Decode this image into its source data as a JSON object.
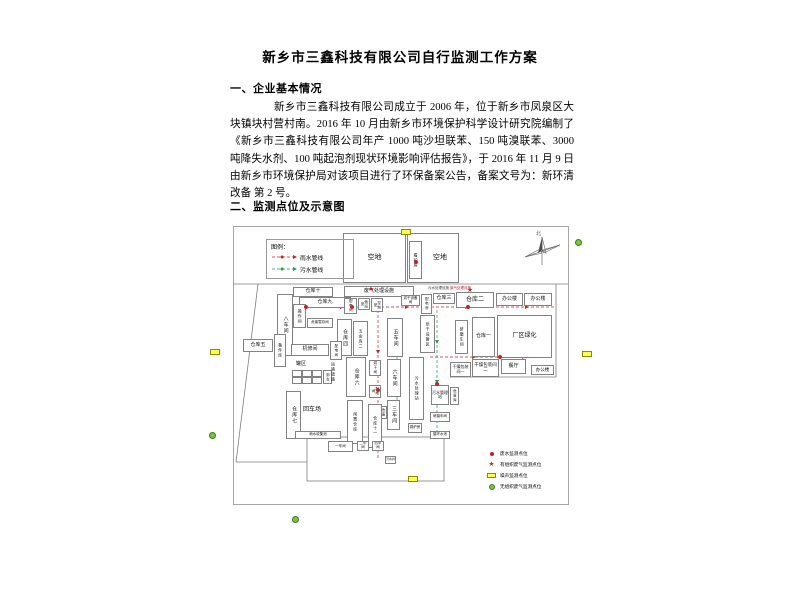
{
  "document": {
    "title": "新乡市三鑫科技有限公司自行监测工作方案",
    "sections": [
      {
        "heading": "一、企业基本情况",
        "paragraph": "新乡市三鑫科技有限公司成立于 2006 年，位于新乡市凤泉区大块镇块村营村南。2016 年 10 月由新乡市环境保护科学设计研究院编制了《新乡市三鑫科技有限公司年产 1000 吨沙坦联苯、150 吨溴联苯、3000 吨降失水剂、100 吨起泡剂现状环境影响评估报告》，于 2016 年 11 月 9 日由新乡市环境保护局对该项目进行了环保备案公告，备案文号为：新环清改备 第 2 号。"
      },
      {
        "heading": "二、监测点位及示意图"
      }
    ]
  },
  "diagram": {
    "legend": {
      "title": "图例：",
      "items": [
        {
          "label": "雨水管线",
          "color": "#c92121"
        },
        {
          "label": "污水管线",
          "color": "#1f9e53"
        }
      ]
    },
    "monitor_legend": [
      {
        "type": "red-dot",
        "label": "废水监测点位"
      },
      {
        "type": "red-star",
        "label": "有组织废气监测点位"
      },
      {
        "type": "yellow-rect",
        "label": "噪声监测点位"
      },
      {
        "type": "green-circle",
        "label": "无组织废气监测点位"
      }
    ],
    "compass_label": "北",
    "colors": {
      "rain": "#c92121",
      "sewage": "#1f9e53",
      "noise": "#ffff4d",
      "fugitive": "#7dc243"
    },
    "rooms": [
      {
        "label": "空地",
        "x": 343,
        "y": 233,
        "w": 63,
        "h": 50,
        "fs": 7
      },
      {
        "label": "空地",
        "x": 407,
        "y": 233,
        "w": 52,
        "h": 50,
        "fs": 7,
        "padl": 14
      },
      {
        "label": "看护房",
        "x": 409,
        "y": 241,
        "w": 13,
        "h": 38,
        "fs": 4,
        "vert": 1
      },
      {
        "label": "仓库十",
        "x": 293,
        "y": 287,
        "w": 40,
        "h": 10,
        "fs": 5
      },
      {
        "label": "仓库九",
        "x": 299,
        "y": 297,
        "w": 52,
        "h": 11,
        "fs": 5
      },
      {
        "label": "废气处理设施",
        "x": 344,
        "y": 286,
        "w": 70,
        "h": 11,
        "fs": 5
      },
      {
        "label": "配电间",
        "x": 344,
        "y": 298,
        "w": 13,
        "h": 16,
        "fs": 3.5,
        "vert": 1
      },
      {
        "label": "值班室",
        "x": 358,
        "y": 298,
        "w": 12,
        "h": 12,
        "fs": 3.5,
        "vert": 1
      },
      {
        "label": "控制室",
        "x": 371,
        "y": 298,
        "w": 12,
        "h": 14,
        "fs": 3.5,
        "vert": 1
      },
      {
        "label": "八车间",
        "x": 277,
        "y": 294,
        "w": 16,
        "h": 62,
        "fs": 5,
        "vert": 1
      },
      {
        "label": "操作间",
        "x": 293,
        "y": 304,
        "w": 13,
        "h": 24,
        "fs": 4,
        "vert": 1
      },
      {
        "label": "危废暂存间",
        "x": 307,
        "y": 318,
        "w": 26,
        "h": 10,
        "fs": 3.5
      },
      {
        "label": "仓库四",
        "x": 337,
        "y": 319,
        "w": 15,
        "h": 37,
        "fs": 5,
        "vert": 1
      },
      {
        "label": "五金库二",
        "x": 353,
        "y": 321,
        "w": 15,
        "h": 35,
        "fs": 4,
        "vert": 1
      },
      {
        "label": "五车间",
        "x": 387,
        "y": 318,
        "w": 16,
        "h": 39,
        "fs": 5,
        "vert": 1
      },
      {
        "label": "六车间",
        "x": 387,
        "y": 359,
        "w": 14,
        "h": 38,
        "fs": 5,
        "vert": 1
      },
      {
        "label": "三车间",
        "x": 387,
        "y": 400,
        "w": 13,
        "h": 30,
        "fs": 5,
        "vert": 1
      },
      {
        "label": "烘干设备间",
        "x": 401,
        "y": 295,
        "w": 19,
        "h": 11,
        "fs": 3.5
      },
      {
        "label": "配电房",
        "x": 421,
        "y": 294,
        "w": 11,
        "h": 20,
        "fs": 3.5,
        "vert": 1
      },
      {
        "label": "烘干设备区",
        "x": 420,
        "y": 315,
        "w": 15,
        "h": 38,
        "fs": 4,
        "vert": 1
      },
      {
        "label": "仓库三",
        "x": 433,
        "y": 293,
        "w": 22,
        "h": 11,
        "fs": 5
      },
      {
        "label": "仓库二",
        "x": 456,
        "y": 292,
        "w": 38,
        "h": 16,
        "fs": 6
      },
      {
        "label": "办公楼",
        "x": 496,
        "y": 293,
        "w": 27,
        "h": 13,
        "fs": 5
      },
      {
        "label": "办公楼",
        "x": 524,
        "y": 293,
        "w": 28,
        "h": 13,
        "fs": 5
      },
      {
        "label": "研磨车间",
        "x": 455,
        "y": 320,
        "w": 13,
        "h": 34,
        "fs": 4,
        "vert": 1
      },
      {
        "label": "仓库一",
        "x": 472,
        "y": 317,
        "w": 23,
        "h": 40,
        "fs": 5
      },
      {
        "label": "厂区绿化",
        "x": 497,
        "y": 315,
        "w": 55,
        "h": 43,
        "fs": 6
      },
      {
        "label": "仓库五",
        "x": 243,
        "y": 339,
        "w": 30,
        "h": 13,
        "fs": 5
      },
      {
        "label": "备件库",
        "x": 274,
        "y": 334,
        "w": 12,
        "h": 33,
        "fs": 4,
        "vert": 1
      },
      {
        "label": "机修间",
        "x": 291,
        "y": 344,
        "w": 38,
        "h": 12,
        "fs": 5
      },
      {
        "label": "配电间",
        "x": 330,
        "y": 341,
        "w": 12,
        "h": 19,
        "fs": 3.5,
        "vert": 1
      },
      {
        "label": "卸车",
        "x": 323,
        "y": 370,
        "w": 9,
        "h": 14,
        "fs": 3.5,
        "vert": 1
      },
      {
        "label": "仓库六",
        "x": 346,
        "y": 357,
        "w": 20,
        "h": 40,
        "fs": 5,
        "vert": 1
      },
      {
        "label": "烘干间",
        "x": 369,
        "y": 360,
        "w": 12,
        "h": 16,
        "fs": 3.5,
        "vert": 1
      },
      {
        "label": "配电间",
        "x": 369,
        "y": 385,
        "w": 12,
        "h": 13,
        "fs": 3.5,
        "vert": 1
      },
      {
        "label": "危废间",
        "x": 376,
        "y": 406,
        "w": 11,
        "h": 13,
        "fs": 3.5,
        "vert": 1
      },
      {
        "label": "仓库七",
        "x": 286,
        "y": 391,
        "w": 15,
        "h": 48,
        "fs": 5,
        "vert": 1
      },
      {
        "label": "闲置仓库",
        "x": 347,
        "y": 400,
        "w": 16,
        "h": 44,
        "fs": 4,
        "vert": 1
      },
      {
        "label": "仓库十一",
        "x": 368,
        "y": 404,
        "w": 14,
        "h": 44,
        "fs": 4,
        "vert": 1
      },
      {
        "label": "污水处理站",
        "x": 409,
        "y": 357,
        "w": 15,
        "h": 63,
        "fs": 4,
        "vert": 1
      },
      {
        "label": "干燥包装间一",
        "x": 450,
        "y": 362,
        "w": 21,
        "h": 15,
        "fs": 4
      },
      {
        "label": "干燥包装间二",
        "x": 472,
        "y": 359,
        "w": 27,
        "h": 18,
        "fs": 4.5
      },
      {
        "label": "餐厅",
        "x": 501,
        "y": 359,
        "w": 25,
        "h": 15,
        "fs": 5
      },
      {
        "label": "办公楼",
        "x": 531,
        "y": 365,
        "w": 23,
        "h": 10,
        "fs": 4.5
      },
      {
        "label": "污水管理站",
        "x": 431,
        "y": 385,
        "w": 18,
        "h": 20,
        "fs": 4
      },
      {
        "label": "危废库",
        "x": 450,
        "y": 387,
        "w": 9,
        "h": 18,
        "fs": 3.5,
        "vert": 1
      },
      {
        "label": "研磨车间",
        "x": 430,
        "y": 412,
        "w": 20,
        "h": 10,
        "fs": 3.5
      },
      {
        "label": "锅炉房",
        "x": 408,
        "y": 423,
        "w": 14,
        "h": 10,
        "fs": 3.5
      },
      {
        "label": "循环水池",
        "x": 430,
        "y": 431,
        "w": 20,
        "h": 8,
        "fs": 3.5
      },
      {
        "label": "雨水收集池",
        "x": 295,
        "y": 431,
        "w": 46,
        "h": 8,
        "fs": 3.5
      },
      {
        "label": "一车间",
        "x": 328,
        "y": 441,
        "w": 25,
        "h": 11,
        "fs": 3.5
      },
      {
        "label": "二车间",
        "x": 357,
        "y": 441,
        "w": 12,
        "h": 10,
        "fs": 3.5
      },
      {
        "label": "四车间",
        "x": 372,
        "y": 441,
        "w": 12,
        "h": 10,
        "fs": 3.5
      },
      {
        "label": "污水井",
        "x": 385,
        "y": 456,
        "w": 11,
        "h": 8,
        "fs": 3
      }
    ],
    "free_labels": [
      {
        "label": "罐区",
        "x": 296,
        "y": 362,
        "fs": 5
      },
      {
        "label": "运输道路",
        "x": 331,
        "y": 362,
        "fs": 4,
        "vert": 1
      },
      {
        "label": "回车场",
        "x": 303,
        "y": 407,
        "fs": 6
      },
      {
        "label": "污水处理设施",
        "x": 428,
        "y": 287,
        "fs": 3.5,
        "color": "#333333"
      },
      {
        "label": "废气处理设施",
        "x": 450,
        "y": 287,
        "fs": 3.5,
        "color": "#c92121"
      }
    ],
    "tanks": {
      "x": 292,
      "y": 370,
      "rows": 2,
      "cols": 3,
      "cw": 10,
      "ch": 7
    },
    "boundaries": [
      [
        233,
        284,
        568,
        284
      ],
      [
        258,
        284,
        236,
        462
      ],
      [
        236,
        462,
        307,
        462
      ],
      [
        556,
        284,
        556,
        377
      ],
      [
        450,
        377,
        556,
        377
      ]
    ],
    "yard": {
      "x": 307,
      "y": 437,
      "w": 137,
      "h": 44
    },
    "pipes_rain": [
      [
        296,
        307,
        556,
        307
      ],
      [
        378,
        300,
        378,
        458
      ],
      [
        430,
        357,
        543,
        357
      ]
    ],
    "pipes_sewage": [
      [
        437,
        310,
        437,
        437
      ],
      [
        397,
        357,
        397,
        432
      ]
    ],
    "arrows_rain": [
      [
        340,
        307,
        "r"
      ],
      [
        405,
        307,
        "r"
      ],
      [
        465,
        307,
        "r"
      ],
      [
        525,
        307,
        "r"
      ],
      [
        378,
        350,
        "d"
      ],
      [
        378,
        420,
        "d"
      ],
      [
        472,
        357,
        "r"
      ],
      [
        522,
        357,
        "r"
      ]
    ],
    "arrows_sewage": [
      [
        437,
        340,
        "d"
      ],
      [
        437,
        380,
        "d"
      ],
      [
        437,
        415,
        "d"
      ],
      [
        397,
        375,
        "d"
      ],
      [
        397,
        410,
        "d"
      ]
    ],
    "wastewater_points": [
      [
        306,
        307
      ],
      [
        352,
        307
      ],
      [
        468,
        307
      ],
      [
        500,
        357
      ],
      [
        437,
        384
      ],
      [
        378,
        390
      ],
      [
        416,
        262
      ]
    ],
    "stack_gas_points": [
      [
        371,
        290
      ],
      [
        470,
        291
      ]
    ],
    "noise_points": [
      [
        406,
        232
      ],
      [
        215,
        352
      ],
      [
        587,
        354
      ],
      [
        413,
        479
      ]
    ],
    "fugitive_gas_points": [
      [
        578,
        242
      ],
      [
        212,
        435
      ],
      [
        295,
        519
      ]
    ]
  }
}
